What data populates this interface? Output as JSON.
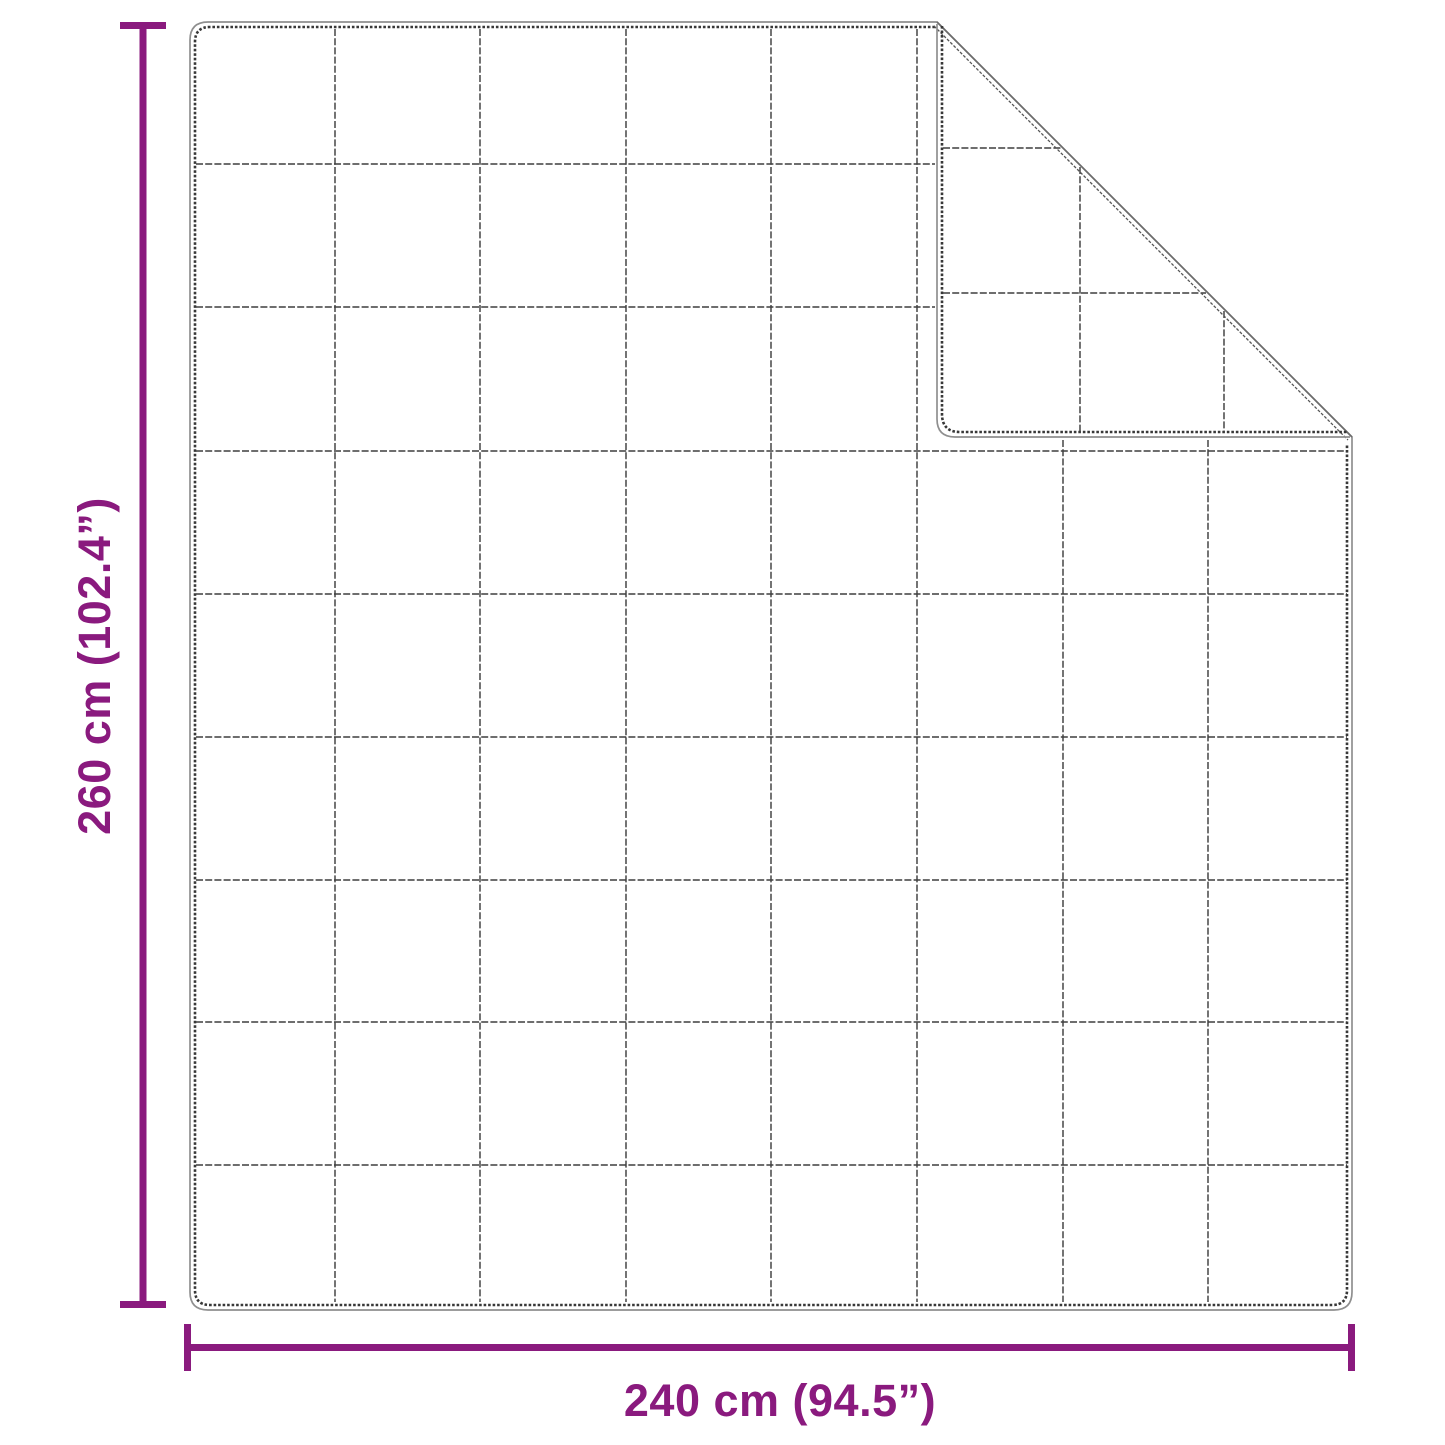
{
  "diagram": {
    "kind": "product-dimension-diagram",
    "subject": "quilted blanket with folded top-right corner",
    "height_dimension": {
      "label": "260 cm (102.4”)"
    },
    "width_dimension": {
      "label": "240 cm (94.5”)"
    },
    "grid": {
      "columns": 8,
      "rows": 9
    },
    "colors": {
      "dimension_accent": "#8A1A7E",
      "outline_outer": "#8f8f8f",
      "outline_stitch": "#383838",
      "grid_line": "#3f3f3f",
      "background": "#ffffff"
    }
  }
}
